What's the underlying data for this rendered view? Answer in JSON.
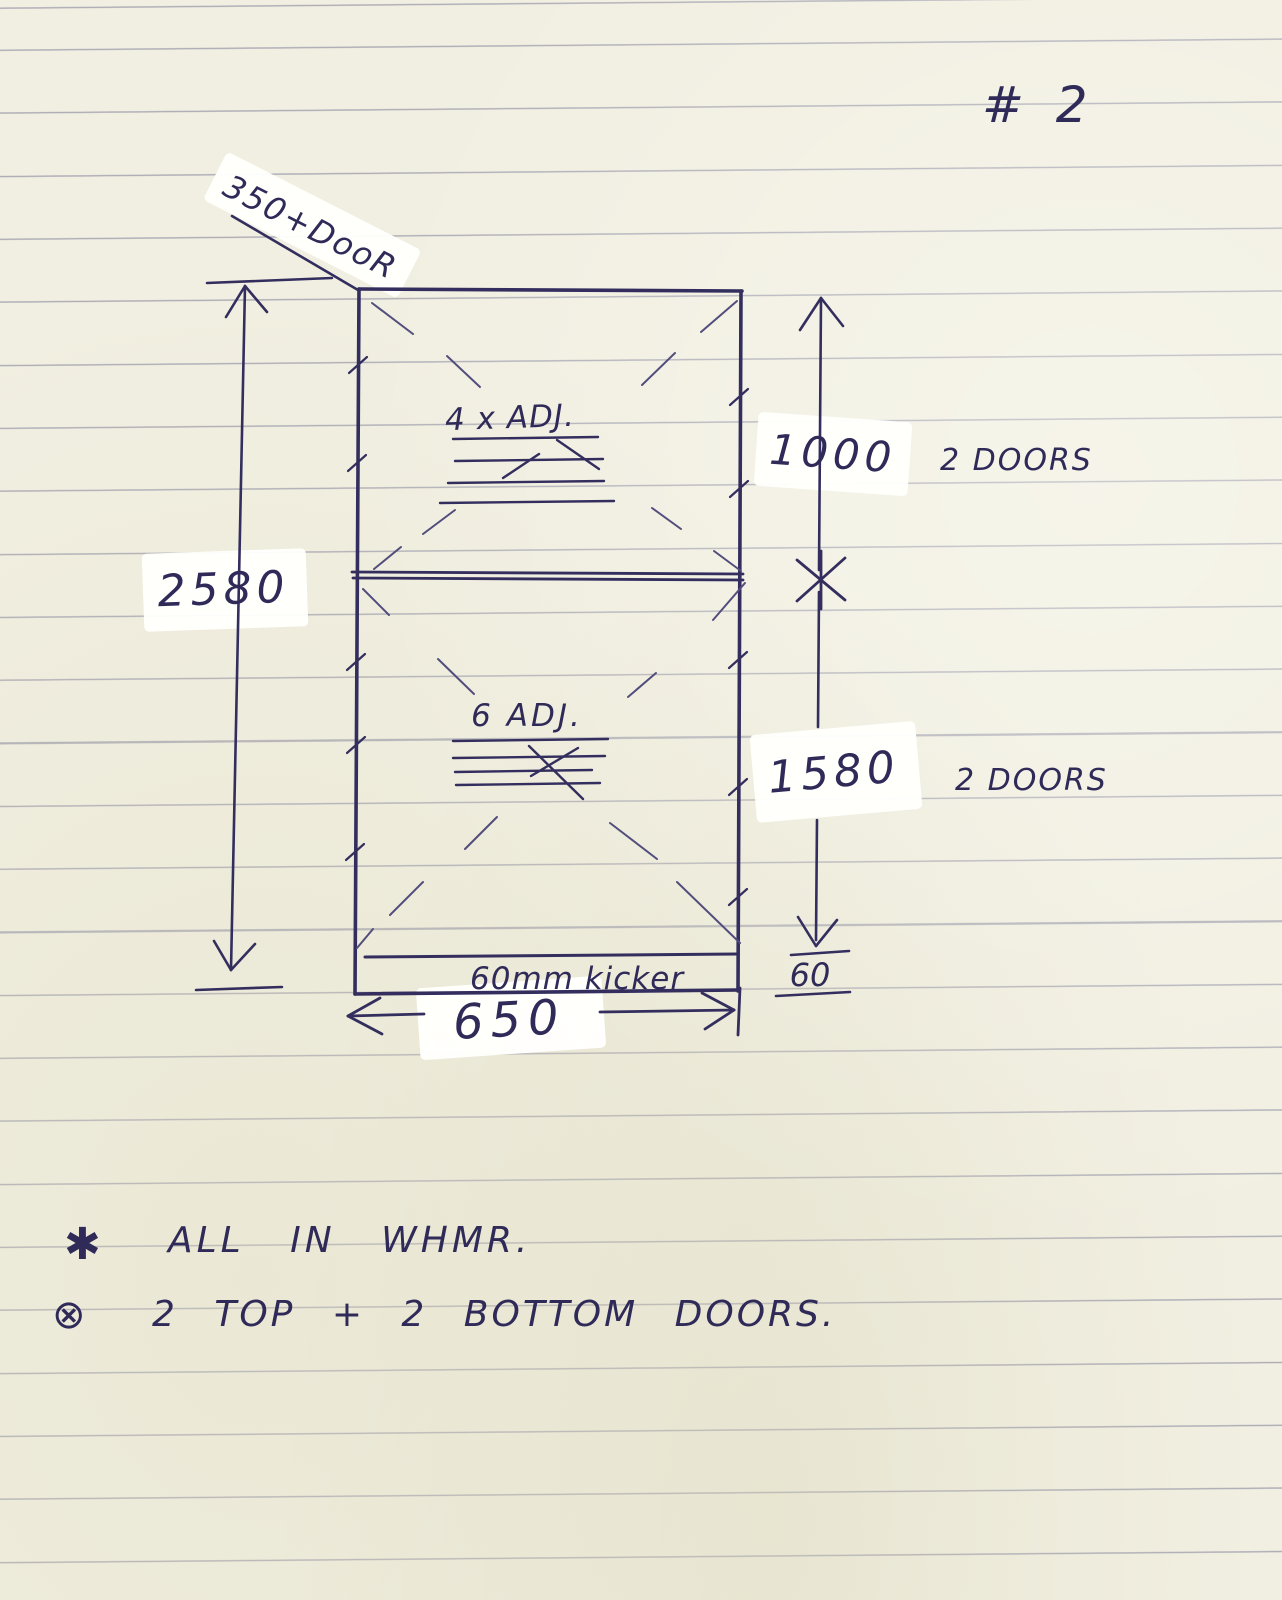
{
  "page_number": "# 2",
  "sketch": {
    "top_door_label": "350+DooR",
    "overall_height": "2580",
    "upper": {
      "shelves": "4 x ADJ.",
      "height": "1000",
      "doors": "2 DOORS"
    },
    "lower": {
      "shelves": "6 ADJ.",
      "height": "1580",
      "doors": "2 DOORS"
    },
    "kicker": {
      "label": "60mm kicker",
      "height": "60"
    },
    "width": "650"
  },
  "notes": [
    {
      "bullet": "✱",
      "text": "ALL IN WHMR."
    },
    {
      "bullet": "⊗",
      "text": "2 TOP + 2 BOTTOM DOORS."
    }
  ],
  "colors": {
    "ink": "#332e5e",
    "paper": "#f1efe1",
    "rule_line": "#7a7a96",
    "label_background": "#ffffff"
  }
}
